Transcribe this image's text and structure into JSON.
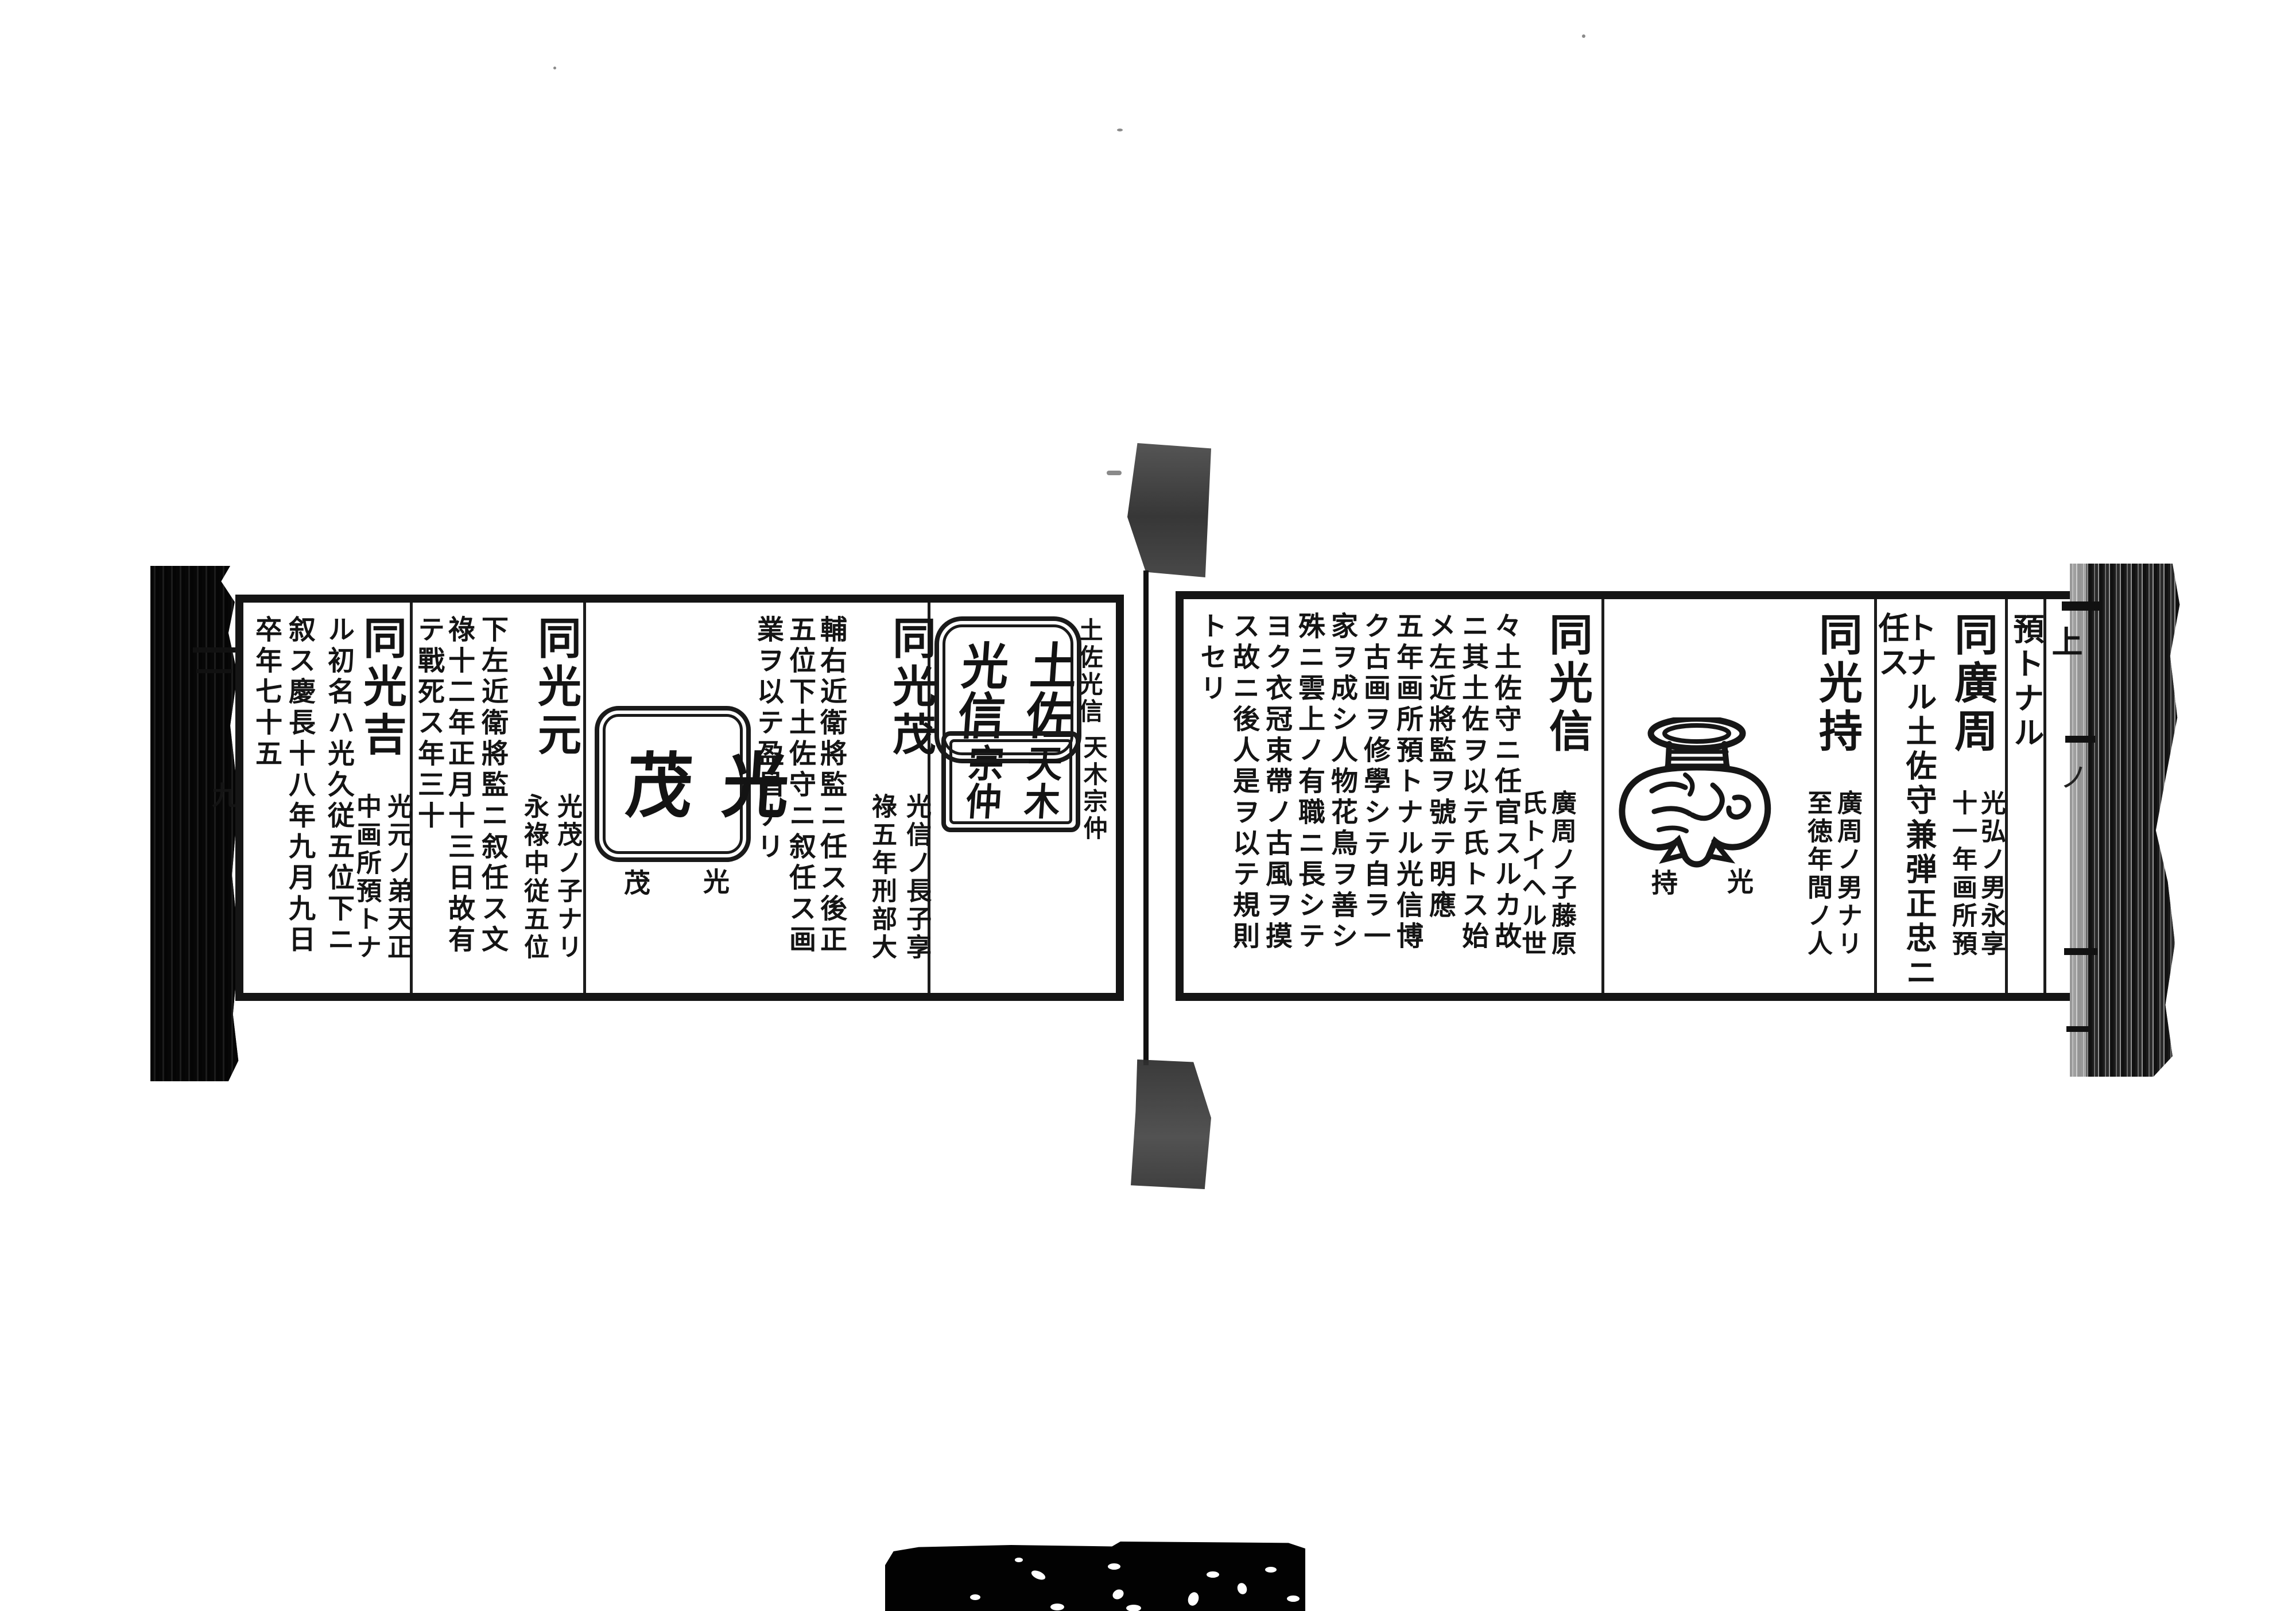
{
  "colors": {
    "ink": "#141414",
    "paper": "#ffffff",
    "scan_edge": "#0c0c0c"
  },
  "left_page": {
    "edge_glyph": "九",
    "seal_section": {
      "label_mitsunobu": "土佐光信",
      "label_munenaka": "天木宗仲",
      "seal_mitsunobu_right": "土佐",
      "seal_mitsunobu_left": "光信",
      "seal_munenaka_right": "天木",
      "seal_munenaka_left": "宗仲"
    },
    "entry_mitsushige": {
      "name": "同光茂",
      "note_right": "光信ノ長子享",
      "note_left": "祿五年刑部大",
      "commentary": [
        "輔右近衛將監ニ任ス後正",
        "五位下土佐守ニ叙任ス画",
        "業ヲ以テ盈昌ナリ"
      ],
      "seal_right": "光",
      "seal_left": "茂",
      "seal_caption_right": "光",
      "seal_caption_left": "茂"
    },
    "entry_mitsumoto": {
      "name": "同光元",
      "note_right": "光茂ノ子ナリ",
      "note_left": "永祿中従五位",
      "commentary": [
        "下左近衛將監ニ叙任ス文",
        "祿十二年正月十三日故有",
        "テ戰死ス年三十"
      ]
    },
    "entry_mitsuyoshi": {
      "name": "同光吉",
      "note_right": "光元ノ弟天正",
      "note_left": "中画所預トナ",
      "commentary": [
        "ル初名ハ光久従五位下ニ",
        "叙ス慶長十八年九月九日",
        "卒年七十五"
      ]
    }
  },
  "right_page": {
    "edge_glyph_top": "上",
    "edge_glyph_mid": "ノ",
    "carryover": "預トナル",
    "entry_hirochika": {
      "name": "同廣周",
      "note_right": "光弘ノ男永享",
      "note_left": "十一年画所預",
      "continuation": [
        "トナル土佐守兼弾正忠ニ",
        "任ス"
      ]
    },
    "entry_mitsumochi": {
      "name": "同光持",
      "note_right": "廣周ノ男ナリ",
      "note_left": "至徳年間ノ人",
      "seal_caption_right": "光",
      "seal_caption_left": "持"
    },
    "entry_mitsunobu": {
      "name": "同光信",
      "note_right": "廣周ノ子藤原",
      "note_left": "氏トイヘル世",
      "commentary": [
        "々土佐守ニ任官スルカ故",
        "ニ其土佐ヲ以テ氏トス始",
        "メ左近將監ヲ號テ明應",
        "五年画所預トナル光信博",
        "ク古画ヲ修學シテ自ラ一",
        "家ヲ成シ人物花鳥ヲ善シ",
        "殊ニ雲上ノ有職ニ長シテ",
        "ヨク衣冠束帶ノ古風ヲ摸",
        "ス故ニ後人是ヲ以テ規則",
        "トセリ"
      ]
    }
  }
}
